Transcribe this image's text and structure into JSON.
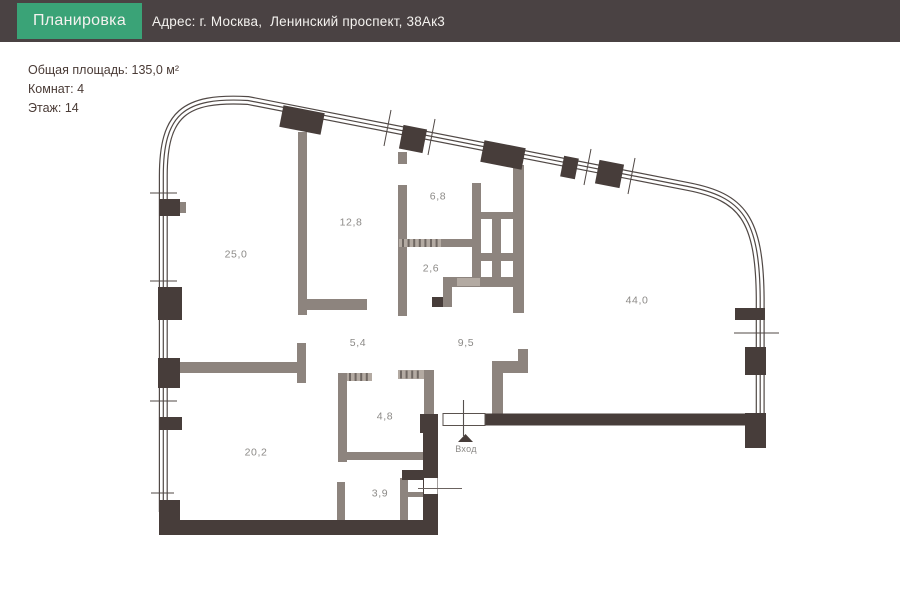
{
  "header": {
    "tab_label": "Планировка",
    "address": "Адрес: г. Москва,  Ленинский проспект, 38Ак3"
  },
  "summary": {
    "total_area": "Общая площадь: 135,0 м²",
    "rooms": "Комнат: 4",
    "floor": "Этаж: 14"
  },
  "plan": {
    "entrance_label": "Вход",
    "rooms": [
      {
        "name": "room-25-0",
        "area": "25,0"
      },
      {
        "name": "room-12-8",
        "area": "12,8"
      },
      {
        "name": "room-6-8",
        "area": "6,8"
      },
      {
        "name": "room-2-6",
        "area": "2,6"
      },
      {
        "name": "room-44-0",
        "area": "44,0"
      },
      {
        "name": "room-5-4",
        "area": "5,4"
      },
      {
        "name": "room-9-5",
        "area": "9,5"
      },
      {
        "name": "room-4-8",
        "area": "4,8"
      },
      {
        "name": "room-20-2",
        "area": "20,2"
      },
      {
        "name": "room-3-9",
        "area": "3,9"
      }
    ]
  },
  "colors": {
    "header_bg": "#4a4243",
    "tab_green": "#3aa377",
    "wall_dark": "#473d3a",
    "wall_gray": "#8d847e",
    "wall_light": "#b3aaa2",
    "line_dark": "#514946",
    "label_gray": "#8c8a87",
    "text_dark": "#4a3b36",
    "text_light": "#f4f2ef"
  }
}
